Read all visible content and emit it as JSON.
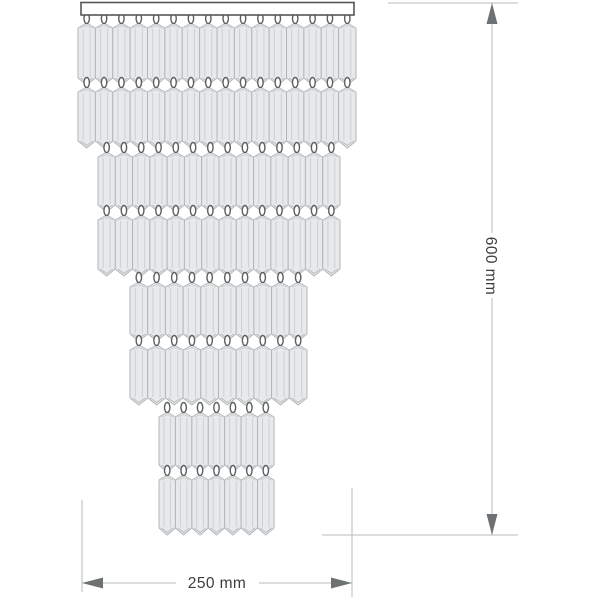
{
  "diagram": {
    "type": "technical-drawing",
    "subject": "cascade crystal chandelier - front elevation with overall dimensions",
    "background": "#ffffff",
    "colors": {
      "crystal_fill": "#e7e9ea",
      "crystal_border": "#b2b6b9",
      "crystal_facet": "#cdd0d2",
      "loop_stroke": "#5d6062",
      "loop_fill": "#ffffff",
      "plate_fill": "#ffffff",
      "plate_border": "#54575a",
      "dim_line": "#babcbe",
      "dim_arrow": "#6e7173",
      "dim_text": "#3a3c3e"
    },
    "plate": {
      "x": 81,
      "y": 2.5,
      "width": 273,
      "height": 12.5
    },
    "crystal": {
      "peak": 5,
      "point": 7,
      "facet_inset": 0.3
    },
    "tiers": [
      {
        "x": 78,
        "width": 278,
        "crystals": 16,
        "rows": [
          [
            23,
            85
          ],
          [
            87,
            148
          ]
        ]
      },
      {
        "x": 98,
        "width": 242,
        "crystals": 14,
        "rows": [
          [
            152,
            212
          ],
          [
            215,
            276
          ]
        ]
      },
      {
        "x": 130,
        "width": 177,
        "crystals": 10,
        "rows": [
          [
            282,
            341
          ],
          [
            345,
            405
          ]
        ]
      },
      {
        "x": 159,
        "width": 115,
        "crystals": 7,
        "rows": [
          [
            412,
            472
          ],
          [
            475,
            535
          ]
        ]
      }
    ],
    "dimensions": {
      "height": {
        "label": "600 mm",
        "value_mm": 600,
        "line_x": 492,
        "from_y": 3,
        "to_y": 535,
        "text_gap": [
          233,
          298
        ],
        "label_pos": [
          486,
          266
        ],
        "ext_top": [
          388,
          518,
          3
        ],
        "ext_bottom": [
          322,
          518,
          535
        ]
      },
      "width": {
        "label": "250 mm",
        "value_mm": 250,
        "line_y": 583,
        "from_x": 82,
        "to_x": 352,
        "text_gap": [
          176,
          259
        ],
        "label_pos": [
          217,
          588
        ],
        "ext_left": [
          82,
          500,
          592
        ],
        "ext_right": [
          352,
          488,
          597
        ]
      },
      "arrow": {
        "length": 21,
        "half_width": 5.5
      }
    }
  }
}
